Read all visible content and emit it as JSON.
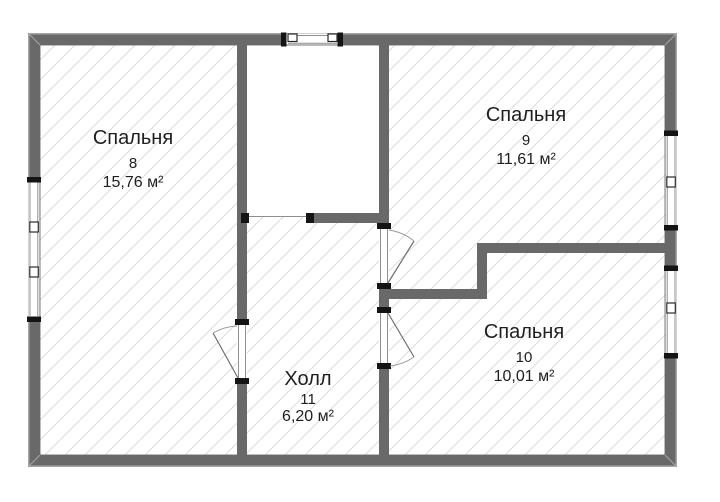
{
  "floor_plan": {
    "rooms": [
      {
        "name": "Спальня",
        "number": "8",
        "area": "15,76 м²"
      },
      {
        "name": "Спальня",
        "number": "9",
        "area": "11,61 м²"
      },
      {
        "name": "Спальня",
        "number": "10",
        "area": "10,01 м²"
      },
      {
        "name": "Холл",
        "number": "11",
        "area": "6,20 м²"
      }
    ],
    "colors": {
      "background": "#ffffff",
      "wall": "#696969",
      "wall_outline": "#a6a6a6",
      "hatch_line": "#dcdcdc",
      "opening_frame": "#8f8f8f",
      "jamb": "#141414",
      "door_arc": "#9a9a9a",
      "text": "#1f1f1f"
    }
  }
}
